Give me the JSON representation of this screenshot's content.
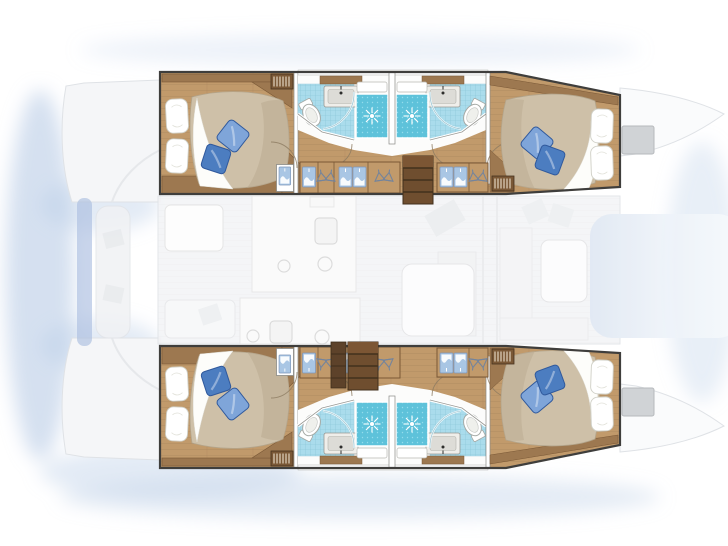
{
  "meta": {
    "title": "Catamaran yacht interior layout - top-down floor plan",
    "description": "4-cabin 4-bathroom sailing catamaran deck plan; hull accommodations rendered in color, main-deck cockpit, galley, saloon and foredeck ghosted in light gray"
  },
  "colors": {
    "bg": "#ffffff",
    "water_glow": "#b9cce6",
    "ghost_fill": "#f3f4f6",
    "ghost_line": "#dfe2e6",
    "ghost_white": "#fbfbfc",
    "hull_outline": "#3f3e3c",
    "wall": "#ffffff",
    "wall_line": "#8a8a86",
    "wood_floor": "#c19a6b",
    "wood_line": "#a5815a",
    "wood_mid": "#9d7850",
    "wood_dark": "#7a5836",
    "wood_stair": "#6f4e2f",
    "tile": "#aadcec",
    "tile_line": "#86c3d6",
    "shower": "#5ec2da",
    "shower_dot": "#93dcec",
    "duvet": "#cec0a8",
    "duvet_shade": "#b9aa90",
    "linen": "#ffffff",
    "pillow_blue_dark": "#4c7dc0",
    "pillow_blue_light": "#7fa5d9",
    "locker_panel": "#a9c6e4",
    "hanger": "#74849c",
    "hatch": "#d0d3d6",
    "davit_blue": "#a9bedf",
    "foredeck_panel": "#dde6f2"
  },
  "legend": {
    "icons": [
      {
        "name": "double-bed-icon",
        "meaning": "double berth with duvet and pillows"
      },
      {
        "name": "blue-pillow-icon",
        "meaning": "decorative cushion"
      },
      {
        "name": "shower-drain-icon",
        "meaning": "shower stall with drain"
      },
      {
        "name": "toilet-icon",
        "meaning": "marine toilet"
      },
      {
        "name": "sink-icon",
        "meaning": "washbasin vanity"
      },
      {
        "name": "hanger-icon",
        "meaning": "hanging wardrobe locker"
      },
      {
        "name": "clothes-panel-icon",
        "meaning": "locker front with hung linen"
      },
      {
        "name": "louver-vent-icon",
        "meaning": "louvered locker door"
      },
      {
        "name": "stairs-icon",
        "meaning": "companionway steps down into hull"
      },
      {
        "name": "deck-hatch-icon",
        "meaning": "foredeck hatch"
      }
    ]
  },
  "structure": {
    "hulls": [
      {
        "id": "top-hull",
        "rooms": [
          "aft-double-cabin",
          "aft-bathroom-with-shower",
          "forward-bathroom-with-shower",
          "forward-double-cabin",
          "wardrobe-corridor",
          "companionway-stairs"
        ]
      },
      {
        "id": "bottom-hull",
        "rooms": [
          "aft-double-cabin",
          "aft-bathroom-with-shower",
          "forward-bathroom-with-shower",
          "forward-double-cabin",
          "wardrobe-corridor",
          "companionway-stairs"
        ]
      }
    ],
    "ghosted_main_deck": [
      "aft-cockpit-with-table-and-bench",
      "galley-with-sinks-and-burners",
      "saloon-table-and-seating",
      "forward-lounge-and-foredeck"
    ]
  }
}
